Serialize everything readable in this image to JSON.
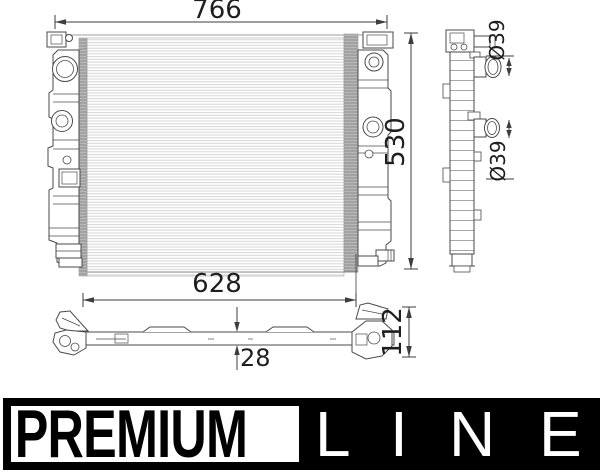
{
  "drawing": {
    "dims": {
      "overall_width": "766",
      "overall_height": "530",
      "bottom_width": "628",
      "bottom_thickness": "28",
      "bottom_height": "112",
      "port_diameter_top": "Ø39",
      "port_diameter_bottom": "Ø39"
    }
  },
  "logo": {
    "premium": "PREMIUM",
    "line_letters": [
      "L",
      "I",
      "N",
      "E"
    ]
  }
}
